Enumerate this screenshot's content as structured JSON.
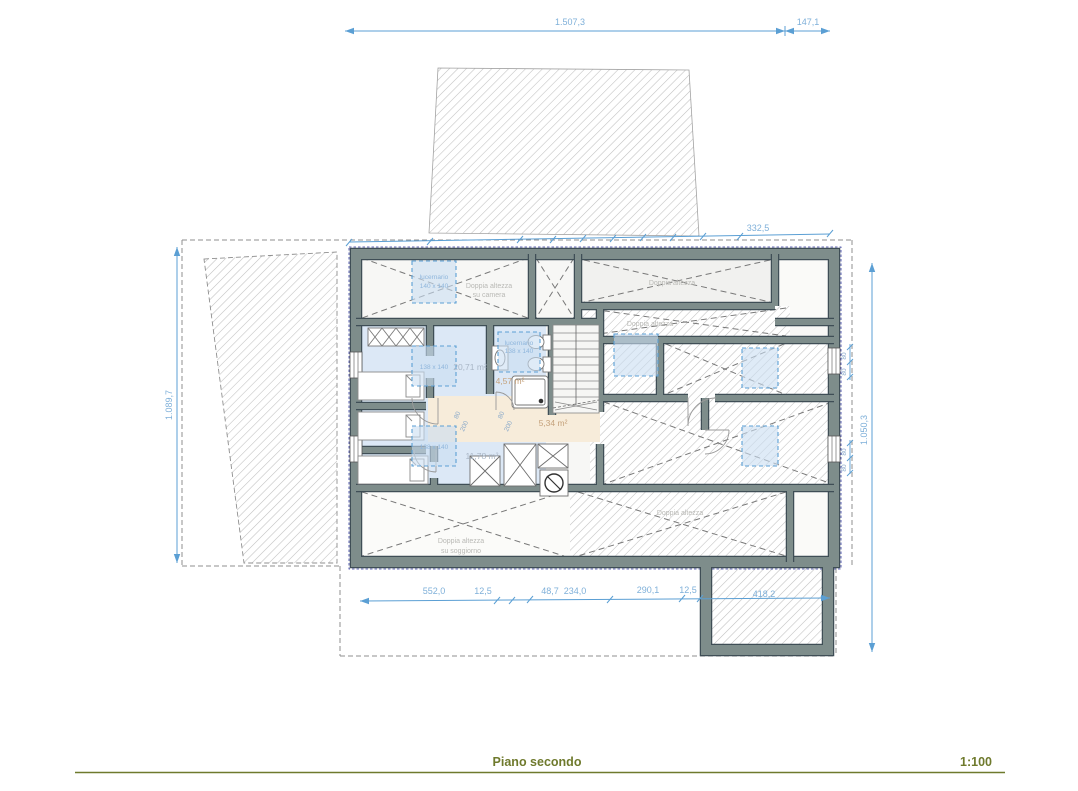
{
  "footer": {
    "title": "Piano secondo",
    "scale": "1:100"
  },
  "dimensions": {
    "top_main": "1.507,3",
    "top_right": "147,1",
    "upper_chain": "332,5",
    "left_total": "1.089,7",
    "right_total": "1.050,3",
    "right_small": [
      "80",
      "80",
      "80",
      "80"
    ],
    "bottom_chain": [
      "552,0",
      "12,5",
      "48,7",
      "234,0",
      "290,1",
      "12,5",
      "418,2"
    ],
    "door_dims": [
      "80",
      "200",
      "80",
      "200"
    ]
  },
  "labels": {
    "skylight_camera_1": "lucernario",
    "skylight_camera_2": "140 x 140",
    "double_height_camera_1": "Doppia altezza",
    "double_height_camera_2": "su camera",
    "double_height_right": "Doppia altezza",
    "double_height_strip": "Doppia altezza",
    "skylight_bath_1": "lucernario",
    "skylight_bath_2": "138 x 140",
    "skylight_left_top": "138 x 140",
    "skylight_left_bottom": "138 x 140",
    "area_bedroom_large": "20,71 m²",
    "area_bathroom": "4,57 m²",
    "area_hallway": "5,34 m²",
    "area_bedroom_small": "11,78 m²",
    "double_height_living_1": "Doppia altezza",
    "double_height_living_2": "su soggiorno",
    "double_height_bottom_right": "Doppia altezza"
  },
  "colors": {
    "dimension_blue": "#5b9fd4",
    "wall_fill": "#7e8d8b",
    "wall_edge": "#3f4e56",
    "room_blue": "#dce8f6",
    "room_tan": "#f7ecda",
    "skylight_fill": "#c9ddf2",
    "footer_olive": "#6f7a2d"
  }
}
